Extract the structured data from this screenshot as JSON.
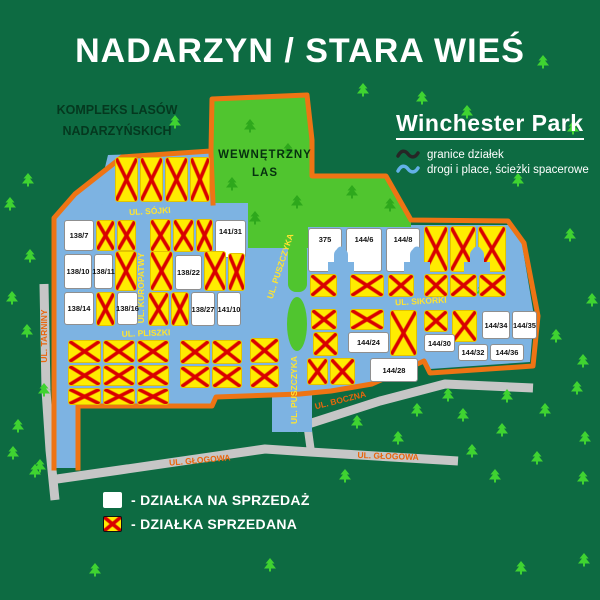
{
  "title": "NADARZYN / STARA WIEŚ",
  "forest_complex": {
    "line1": "KOMPLEKS LASÓW",
    "line2": "NADARZYŃSKICH"
  },
  "inner_forest": {
    "line1": "WEWNĘTRZNY",
    "line2": "LAS"
  },
  "park": {
    "name": "Winchester Park",
    "legend": [
      {
        "icon": "boundary-squiggle-icon",
        "color": "#262626",
        "label": "granice działek"
      },
      {
        "icon": "road-squiggle-icon",
        "color": "#63b1e8",
        "label": "drogi i place, ścieżki spacerowe"
      }
    ]
  },
  "legend": {
    "for_sale": "- DZIAŁKA NA SPRZEDAŻ",
    "sold": "- DZIAŁKA SPRZEDANA"
  },
  "colors": {
    "background": "#0d6b42",
    "forest": "#50c52f",
    "boundary_orange": "#ee7414",
    "road_blue": "#7db3e2",
    "road_gray": "#c6c6c6",
    "plot_sold_yellow": "#ffec00",
    "plot_x_red": "#d90000",
    "street_label_yellow": "#ffe430",
    "street_label_orange": "#e8660c"
  },
  "map": {
    "streets": [
      {
        "name": "UL. SÓJKI",
        "x": 150,
        "y": 214,
        "rot": -3,
        "on": "blue"
      },
      {
        "name": "UL. KUROPATWY",
        "x": 144,
        "y": 288,
        "rot": -90,
        "on": "blue"
      },
      {
        "name": "UL. PLISZKI",
        "x": 146,
        "y": 336,
        "rot": -2,
        "on": "blue"
      },
      {
        "name": "UL. PUSZCZYKA",
        "x": 283,
        "y": 267,
        "rot": -72,
        "on": "blue"
      },
      {
        "name": "UL. PUSZCZYKA",
        "x": 297,
        "y": 390,
        "rot": -90,
        "on": "blue"
      },
      {
        "name": "UL. SIKORKI",
        "x": 421,
        "y": 304,
        "rot": -3,
        "on": "blue"
      },
      {
        "name": "UL. TARNINY",
        "x": 47,
        "y": 336,
        "rot": -90,
        "on": "gray"
      },
      {
        "name": "UL. GŁOGOWA",
        "x": 200,
        "y": 463,
        "rot": -5,
        "on": "gray"
      },
      {
        "name": "UL. GŁOGOWA",
        "x": 388,
        "y": 459,
        "rot": 2,
        "on": "gray"
      },
      {
        "name": "UL. BOCZNA",
        "x": 341,
        "y": 403,
        "rot": -14,
        "on": "gray"
      }
    ],
    "plots": [
      [
        115,
        157,
        23,
        45,
        "",
        1
      ],
      [
        140,
        157,
        23,
        45,
        "",
        1
      ],
      [
        165,
        157,
        23,
        45,
        "",
        1
      ],
      [
        190,
        157,
        20,
        45,
        "",
        1
      ],
      [
        64,
        220,
        30,
        31,
        "138/7",
        0
      ],
      [
        96,
        220,
        19,
        31,
        "",
        1
      ],
      [
        117,
        220,
        19,
        31,
        "",
        1
      ],
      [
        150,
        219,
        21,
        33,
        "",
        1
      ],
      [
        173,
        219,
        21,
        33,
        "",
        1
      ],
      [
        196,
        219,
        17,
        33,
        "",
        1
      ],
      [
        215,
        220,
        31,
        38,
        "141/31",
        0
      ],
      [
        64,
        254,
        28,
        35,
        "138/10",
        0
      ],
      [
        94,
        254,
        19,
        35,
        "138/11",
        0
      ],
      [
        115,
        251,
        22,
        40,
        "",
        1
      ],
      [
        150,
        251,
        23,
        40,
        "",
        1
      ],
      [
        175,
        255,
        27,
        35,
        "138/22",
        0
      ],
      [
        204,
        251,
        22,
        40,
        "",
        1
      ],
      [
        228,
        253,
        17,
        38,
        "",
        1
      ],
      [
        64,
        292,
        30,
        33,
        "138/14",
        0
      ],
      [
        96,
        292,
        19,
        34,
        "",
        1
      ],
      [
        117,
        292,
        21,
        33,
        "138/16",
        0
      ],
      [
        148,
        292,
        21,
        34,
        "",
        1
      ],
      [
        171,
        292,
        18,
        34,
        "",
        1
      ],
      [
        191,
        292,
        24,
        34,
        "138/27",
        0
      ],
      [
        217,
        292,
        24,
        34,
        "141/10",
        0
      ],
      [
        68,
        340,
        33,
        23,
        "",
        1
      ],
      [
        103,
        340,
        32,
        23,
        "",
        1
      ],
      [
        137,
        340,
        32,
        23,
        "",
        1
      ],
      [
        180,
        340,
        30,
        24,
        "",
        1
      ],
      [
        212,
        340,
        30,
        24,
        "",
        1
      ],
      [
        250,
        338,
        29,
        25,
        "",
        1
      ],
      [
        68,
        365,
        33,
        21,
        "",
        1
      ],
      [
        103,
        365,
        32,
        21,
        "",
        1
      ],
      [
        137,
        365,
        32,
        21,
        "",
        1
      ],
      [
        180,
        366,
        30,
        22,
        "",
        1
      ],
      [
        212,
        366,
        30,
        22,
        "",
        1
      ],
      [
        250,
        365,
        29,
        23,
        "",
        1
      ],
      [
        68,
        388,
        33,
        17,
        "",
        1
      ],
      [
        103,
        388,
        32,
        17,
        "",
        1
      ],
      [
        137,
        388,
        32,
        17,
        "",
        1
      ],
      [
        308,
        228,
        34,
        44,
        "375",
        0
      ],
      [
        346,
        228,
        36,
        44,
        "144/6",
        0
      ],
      [
        386,
        228,
        34,
        44,
        "144/8",
        0
      ],
      [
        424,
        226,
        24,
        46,
        "",
        1
      ],
      [
        450,
        226,
        26,
        46,
        "",
        1
      ],
      [
        478,
        226,
        28,
        46,
        "",
        1
      ],
      [
        310,
        274,
        27,
        23,
        "",
        1
      ],
      [
        350,
        274,
        34,
        23,
        "",
        1
      ],
      [
        388,
        274,
        26,
        23,
        "",
        1
      ],
      [
        424,
        274,
        24,
        23,
        "",
        1
      ],
      [
        450,
        274,
        27,
        23,
        "",
        1
      ],
      [
        479,
        274,
        27,
        23,
        "",
        1
      ],
      [
        311,
        309,
        26,
        21,
        "",
        1
      ],
      [
        350,
        309,
        34,
        21,
        "",
        1
      ],
      [
        390,
        310,
        27,
        46,
        "",
        1
      ],
      [
        424,
        310,
        24,
        22,
        "",
        1
      ],
      [
        452,
        310,
        25,
        32,
        "",
        1
      ],
      [
        482,
        311,
        28,
        28,
        "144/34",
        0
      ],
      [
        512,
        311,
        25,
        28,
        "144/35",
        0
      ],
      [
        313,
        332,
        25,
        24,
        "",
        1
      ],
      [
        348,
        332,
        41,
        21,
        "144/24",
        0
      ],
      [
        424,
        334,
        31,
        18,
        "144/30",
        0
      ],
      [
        307,
        358,
        21,
        27,
        "",
        1
      ],
      [
        330,
        358,
        25,
        27,
        "",
        1
      ],
      [
        370,
        358,
        48,
        24,
        "144/28",
        0
      ],
      [
        458,
        344,
        30,
        17,
        "144/32",
        0
      ],
      [
        490,
        344,
        34,
        17,
        "144/36",
        0
      ]
    ],
    "arches": [
      341,
      417,
      477
    ],
    "trees": [
      [
        28,
        182
      ],
      [
        10,
        206
      ],
      [
        30,
        258
      ],
      [
        12,
        300
      ],
      [
        27,
        333
      ],
      [
        44,
        392
      ],
      [
        18,
        428
      ],
      [
        40,
        468
      ],
      [
        13,
        455
      ],
      [
        35,
        473
      ],
      [
        175,
        124
      ],
      [
        363,
        92
      ],
      [
        422,
        100
      ],
      [
        467,
        114
      ],
      [
        543,
        64
      ],
      [
        573,
        130
      ],
      [
        518,
        182
      ],
      [
        570,
        237
      ],
      [
        592,
        302
      ],
      [
        482,
        292
      ],
      [
        556,
        338
      ],
      [
        583,
        363
      ],
      [
        577,
        390
      ],
      [
        448,
        397
      ],
      [
        507,
        398
      ],
      [
        463,
        417
      ],
      [
        545,
        412
      ],
      [
        502,
        432
      ],
      [
        472,
        453
      ],
      [
        537,
        460
      ],
      [
        585,
        440
      ],
      [
        495,
        478
      ],
      [
        583,
        480
      ],
      [
        357,
        424
      ],
      [
        417,
        412
      ],
      [
        398,
        440
      ],
      [
        345,
        478
      ],
      [
        521,
        570
      ],
      [
        584,
        562
      ],
      [
        95,
        572
      ],
      [
        270,
        567
      ]
    ],
    "forest_trees": [
      [
        250,
        128
      ],
      [
        288,
        152
      ],
      [
        232,
        186
      ],
      [
        297,
        204
      ],
      [
        255,
        220
      ],
      [
        352,
        194
      ],
      [
        390,
        207
      ]
    ]
  }
}
